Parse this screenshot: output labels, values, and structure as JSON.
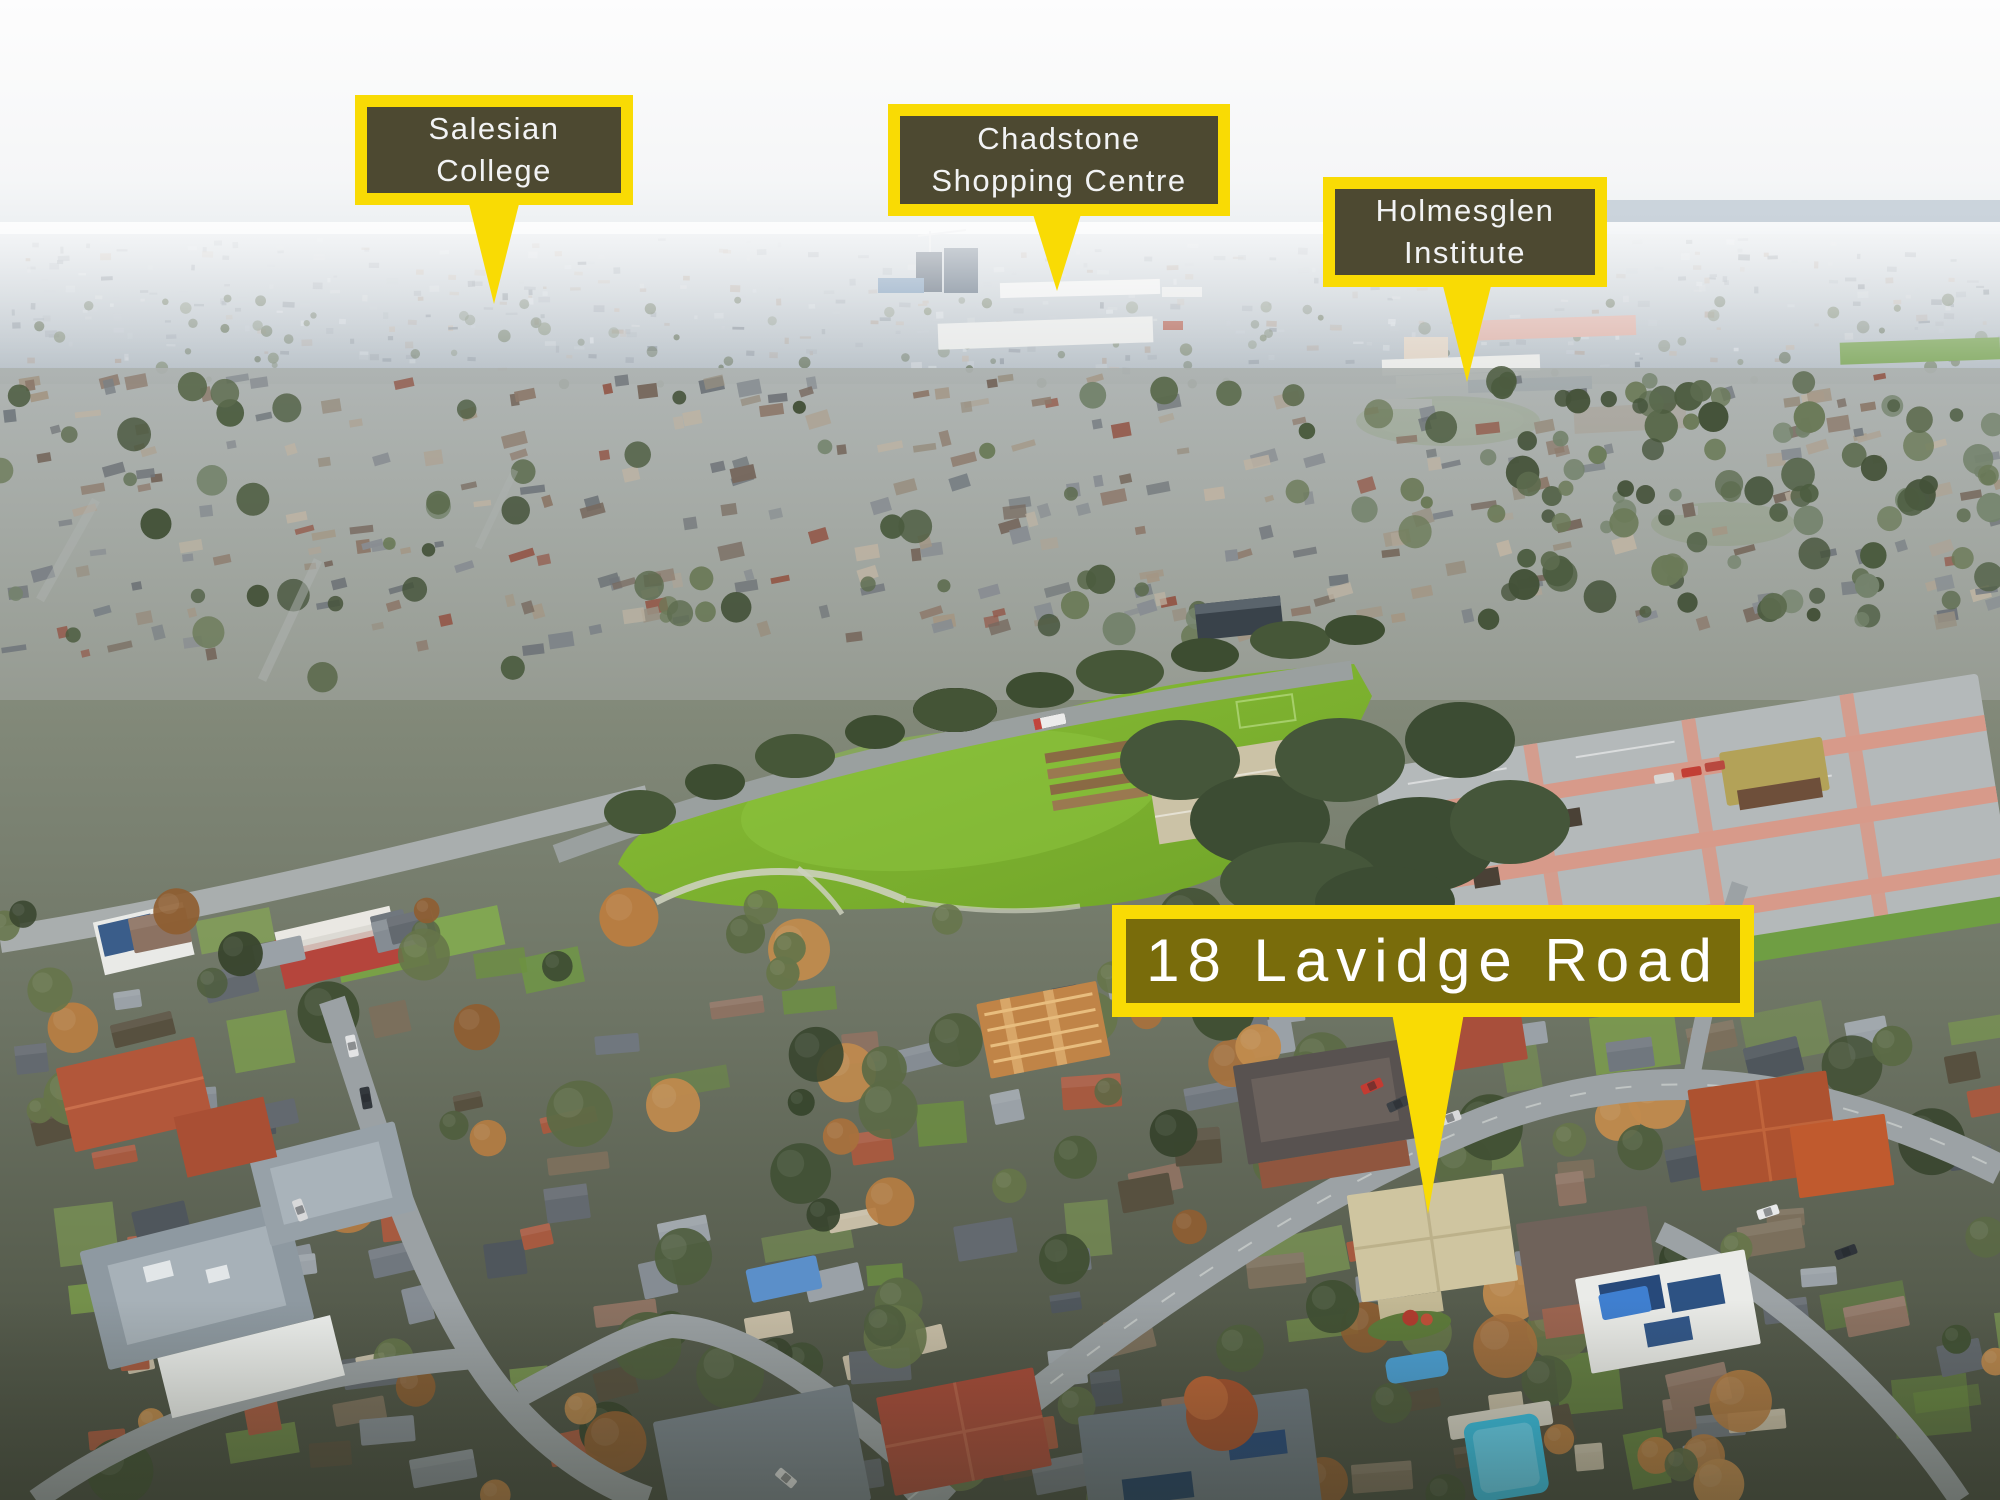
{
  "page_title": "Aerial suburb photograph with property location callouts",
  "style": {
    "callout_border_yellow": "#F9DB04",
    "callout_fill_dark": "#343438",
    "callout_text": "#FFFFFF",
    "park_green": "#7FB434",
    "sky_white": "#FBFCFD"
  },
  "callouts": [
    {
      "id": "salesian-college",
      "lines": [
        "Salesian",
        "College"
      ]
    },
    {
      "id": "chadstone-shopping-centre",
      "lines": [
        "Chadstone",
        "Shopping Centre"
      ]
    },
    {
      "id": "holmesglen-institute",
      "lines": [
        "Holmesglen",
        "Institute"
      ]
    },
    {
      "id": "property-address",
      "lines": [
        "18 Lavidge Road"
      ]
    }
  ]
}
